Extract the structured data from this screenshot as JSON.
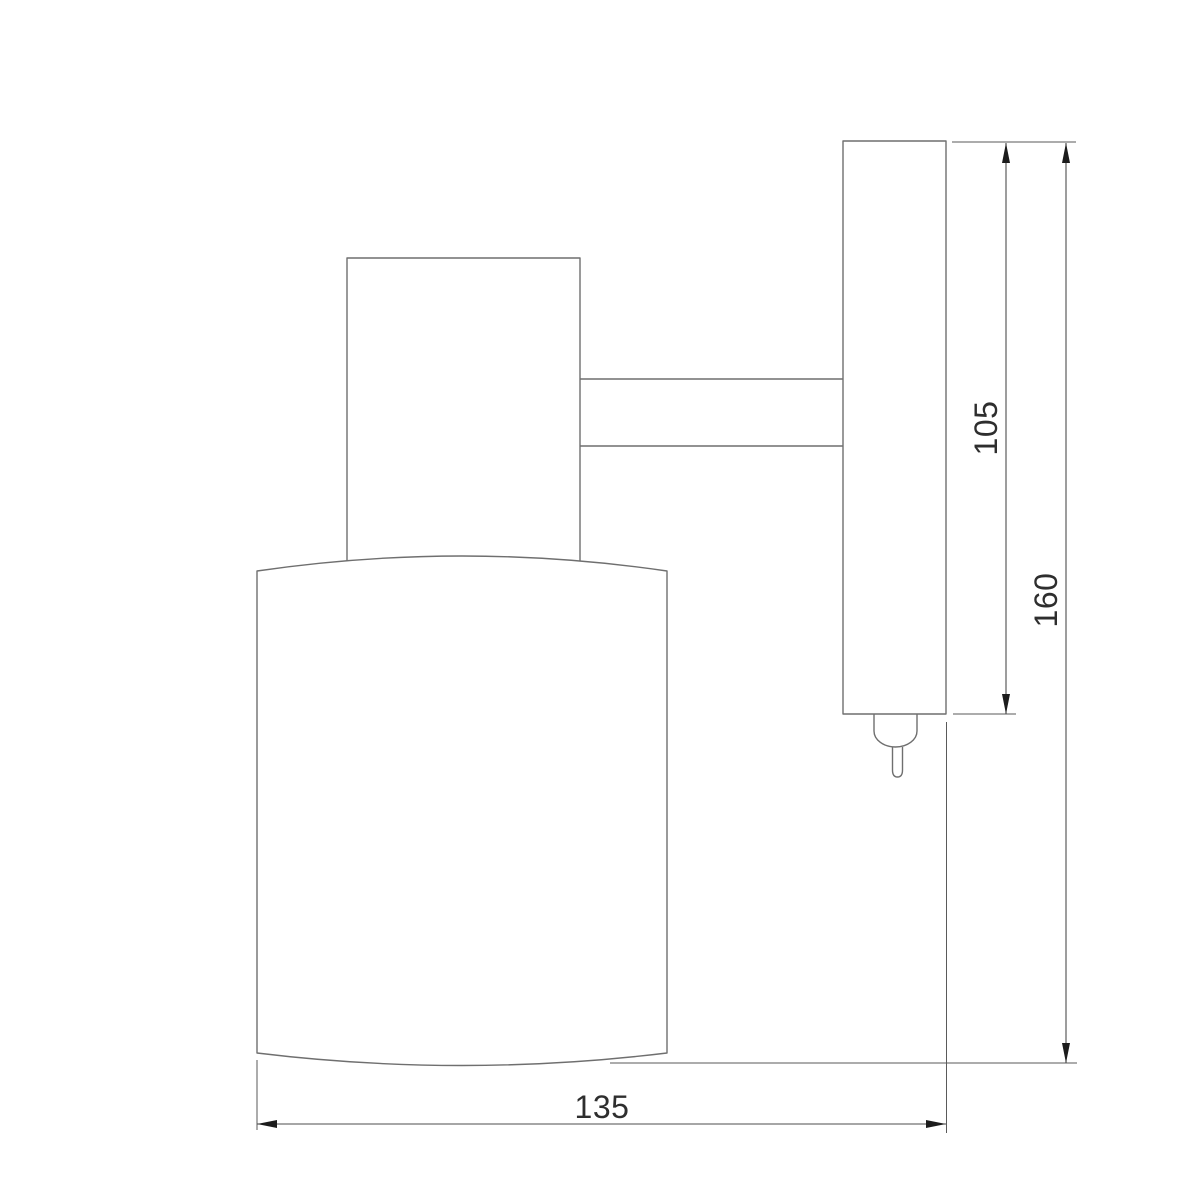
{
  "drawing": {
    "type": "technical-dimension-drawing",
    "subject": "wall-mounted-spot-lamp-side-view",
    "dimensions": {
      "backplate_height": {
        "value": "105",
        "orientation": "vertical"
      },
      "overall_height": {
        "value": "160",
        "orientation": "vertical"
      },
      "overall_depth": {
        "value": "135",
        "orientation": "horizontal"
      }
    },
    "colors": {
      "background": "#ffffff",
      "outline": "#6f6f6f",
      "dimension_line": "#4d4d4d",
      "extension_line": "#5a5a5a",
      "arrow": "#1c1c1c",
      "text": "#2e2e2e"
    }
  }
}
